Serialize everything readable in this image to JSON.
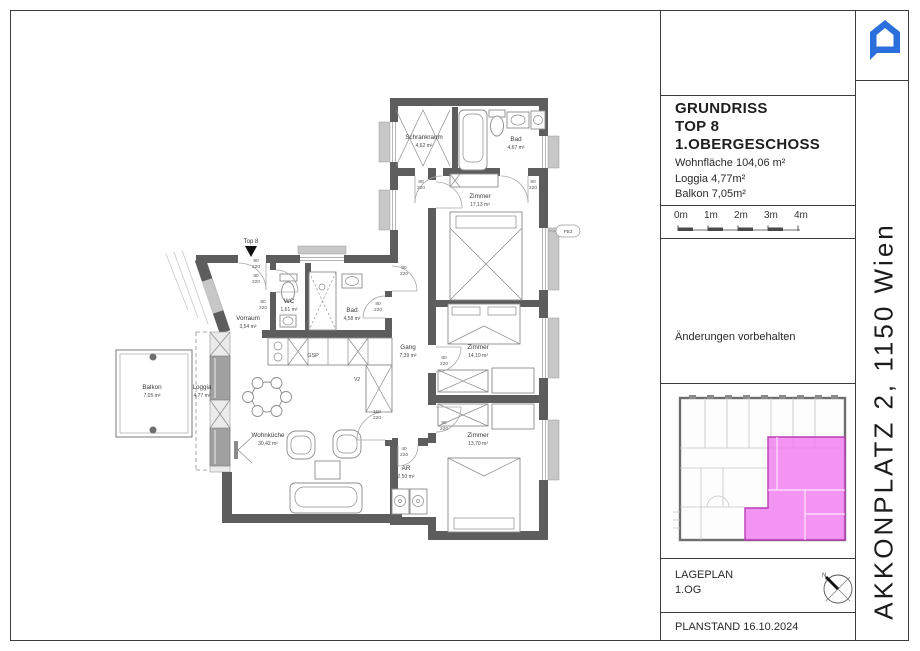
{
  "colors": {
    "accent_blue": "#2a6fdb",
    "highlight_pink": "#f07df0",
    "wall_gray": "#5d5d5d"
  },
  "titleblock": {
    "title_line1": "GRUNDRISS",
    "title_line2": "TOP 8",
    "title_line3": "1.OBERGESCHOSS",
    "area_line1": "Wohnfläche 104,06 m²",
    "area_line2": "Loggia 4,77m²",
    "area_line3": "Balkon 7,05m²",
    "scale_labels": [
      "0m",
      "1m",
      "2m",
      "3m",
      "4m"
    ],
    "note": "Änderungen vorbehalten",
    "lageplan_label": "LAGEPLAN",
    "lageplan_floor": "1.OG",
    "planstand": "PLANSTAND 16.10.2024"
  },
  "sidebar": {
    "project": "AKKONPLATZ 2, 1150 Wien"
  },
  "plan": {
    "entrance_label": "Top 8",
    "facade_label": "FB3",
    "misc": {
      "gsp": "GSP",
      "v2": "V2"
    },
    "rooms": [
      {
        "name": "Schrankraum",
        "area": "4,62 m²"
      },
      {
        "name": "Bad",
        "area": "4,67 m²"
      },
      {
        "name": "Zimmer",
        "area": "17,13 m²"
      },
      {
        "name": "Zimmer",
        "area": "14,10 m²"
      },
      {
        "name": "Zimmer",
        "area": "13,70 m²"
      },
      {
        "name": "Gang",
        "area": "7,39 m²"
      },
      {
        "name": "AR",
        "area": "2,50 m²"
      },
      {
        "name": "WC",
        "area": "1,61 m²"
      },
      {
        "name": "Bad",
        "area": "4,58 m²"
      },
      {
        "name": "Vorraum",
        "area": "3,54 m²"
      },
      {
        "name": "Wohnküche",
        "area": "30,42 m²"
      },
      {
        "name": "Loggia",
        "area": "4,77 m²"
      },
      {
        "name": "Balkon",
        "area": "7,05 m²"
      }
    ],
    "doors": [
      {
        "top": "80",
        "bottom": "220"
      },
      {
        "top": "80",
        "bottom": "220"
      },
      {
        "top": "80",
        "bottom": "220"
      },
      {
        "top": "90",
        "bottom": "220"
      },
      {
        "top": "80",
        "bottom": "220"
      },
      {
        "top": "80",
        "bottom": "220"
      },
      {
        "top": "80",
        "bottom": "220"
      },
      {
        "top": "80",
        "bottom": "220"
      },
      {
        "top": "80",
        "bottom": "220"
      },
      {
        "top": "110",
        "bottom": "220"
      },
      {
        "top": "40",
        "bottom": "220"
      }
    ]
  }
}
